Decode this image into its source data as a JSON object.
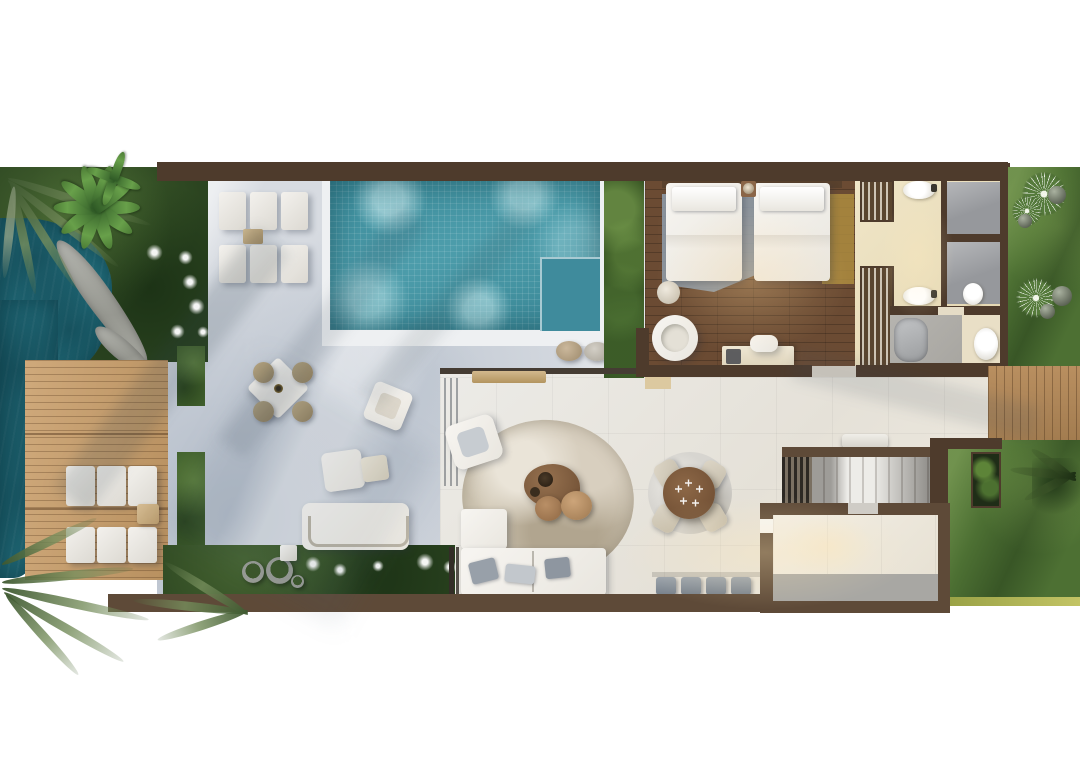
{
  "meta": {
    "type": "architectural-floor-plan-render",
    "view": "top-down",
    "canvas": {
      "width": 1080,
      "height": 780
    }
  },
  "palette": {
    "page_bg": "#ffffff",
    "wall": "#4e3b2c",
    "wall_light": "#5e4a38",
    "water": "#226e7c",
    "pool": "#4897a6",
    "pool_shallow": "#3f8b9c",
    "pool_rim": "#eef0f2",
    "patio": "#d7dbe1",
    "interior_floor": "#e9e5df",
    "deck_wood": "#c6a071",
    "deck_wood_right": "#b08757",
    "bedroom_wood": "#6b4b33",
    "garden_dark": "#2b4420",
    "garden_mid": "#3f5e2b",
    "garden_bright": "#4d7033",
    "hedge": "#2e4a1d",
    "rug_blue": "#919eac",
    "rug_gold": "#ad8c3f",
    "rug_round": "#cbc2b0",
    "rug_dining": "#d7d5d0",
    "furniture_white": "#f4f2ed",
    "pillow_gray": "#98a0a9",
    "shower_gray": "#96989c",
    "bath_cream": "#e8dcbc",
    "bath_mat": "#e9dfc6",
    "tub_gray": "#a9abad",
    "table_wood": "#7c583a",
    "chair_cream": "#d7cfc0",
    "stool_gray": "#87919b",
    "room_mat": "#a8a7a3",
    "bench_wood": "#c8ad84",
    "screen_dark": "#2c2823",
    "stairs_light": "#edece8",
    "stairs_mid": "#c8c5c0"
  },
  "rooms": [
    "lagoon",
    "tropical-garden",
    "pool-terrace",
    "swimming-pool",
    "sun-deck",
    "outdoor-lounge",
    "bedroom",
    "walk-in-wardrobe",
    "shower-room-1",
    "shower-room-2",
    "bathroom",
    "living-room",
    "dining-area",
    "kitchen-bar",
    "staircase",
    "utility-room",
    "side-garden",
    "rear-garden"
  ],
  "furniture": {
    "sun_loungers_poolside": 6,
    "sun_loungers_deck": 2,
    "outdoor_dining_table": 1,
    "outdoor_dining_chairs": 4,
    "outdoor_sofa": 1,
    "outdoor_armchairs": 2,
    "beds": 2,
    "bedroom_armchair": 1,
    "desk": 1,
    "wardrobes": 2,
    "sinks": 2,
    "showers": 2,
    "toilets": 2,
    "bathtub": 1,
    "indoor_sofa": 1,
    "chaise": 1,
    "lounge_armchair": 1,
    "coffee_table": 1,
    "poufs": 2,
    "dining_table_round": 1,
    "dining_chairs": 4,
    "bar_stools": 4,
    "stair_steps": 9
  }
}
